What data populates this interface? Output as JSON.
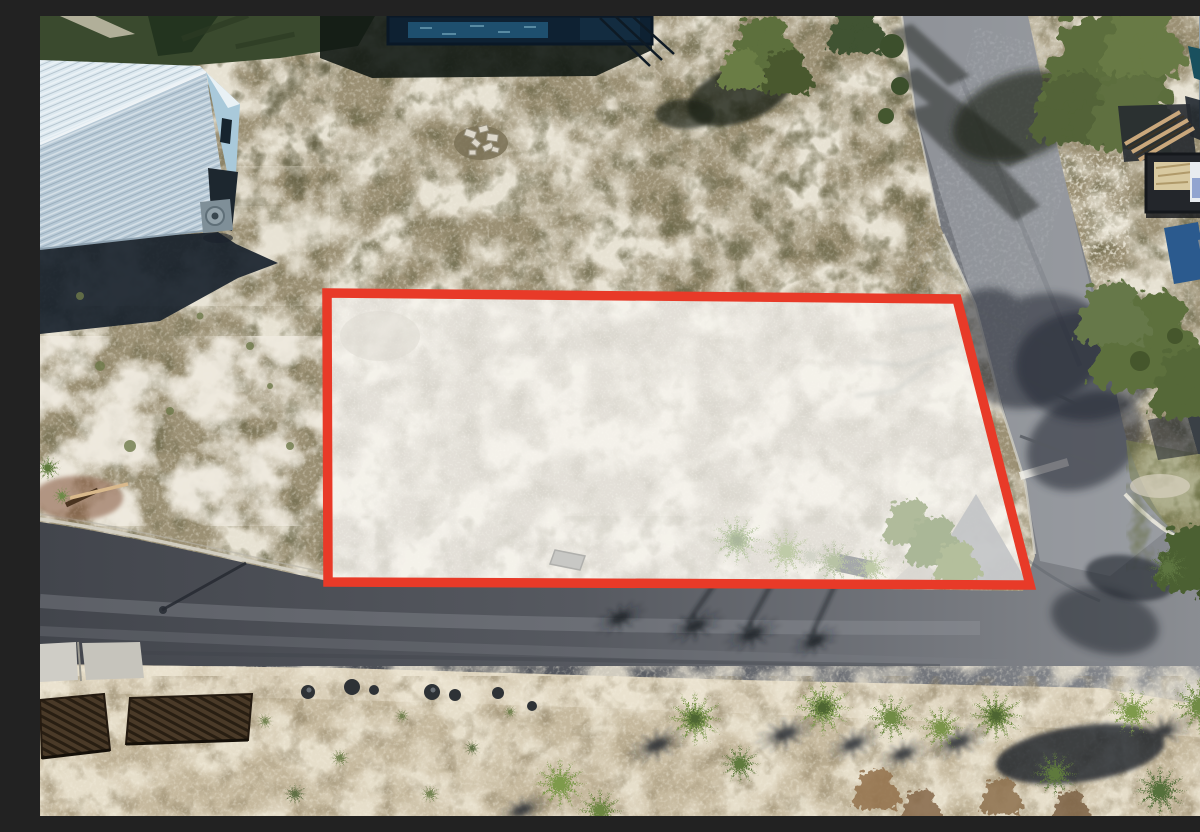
{
  "scene": {
    "description": "Aerial drone photograph of a cleared vacant coastal lot highlighted with a thick red boundary outline. The lot is bordered on the south by a dark asphalt road with palm-tree shadows, on the east by a lighter paved road that curves past a neighboring home site with a dumpster and building materials, a blue metal-roof house sits to the northwest, a dark pool structure to the north, and a strip of palms, palmettos and weathered wooden decking runs along the bottom of the frame.",
    "type": "real-estate-aerial-photo",
    "elements": [
      "highlighted-lot",
      "red-boundary-outline",
      "asphalt-road-south",
      "paved-road-east",
      "intersection-stop-line",
      "blue-metal-roof-house",
      "pool-structure",
      "scrub-terrain",
      "palm-row",
      "palm-shadows",
      "wooden-decks",
      "construction-dumpster",
      "lumber-stack",
      "neighbor-house-white",
      "trees-and-shadows",
      "debris-pile",
      "concrete-pads",
      "curb-lines",
      "utility-pole-shadow"
    ]
  },
  "colors": {
    "outline": "#e83a28",
    "wash": "rgba(255,255,255,0.46)",
    "asphalt_dark": "#42454c",
    "asphalt_light": "#8e9196",
    "sand": "#ece7d9",
    "scrub": "#9b9074",
    "grass": "#3a4a2e",
    "roof_blue": "#c6d7e2",
    "palm": "#6f8c44",
    "shadow": "#1a222c"
  }
}
